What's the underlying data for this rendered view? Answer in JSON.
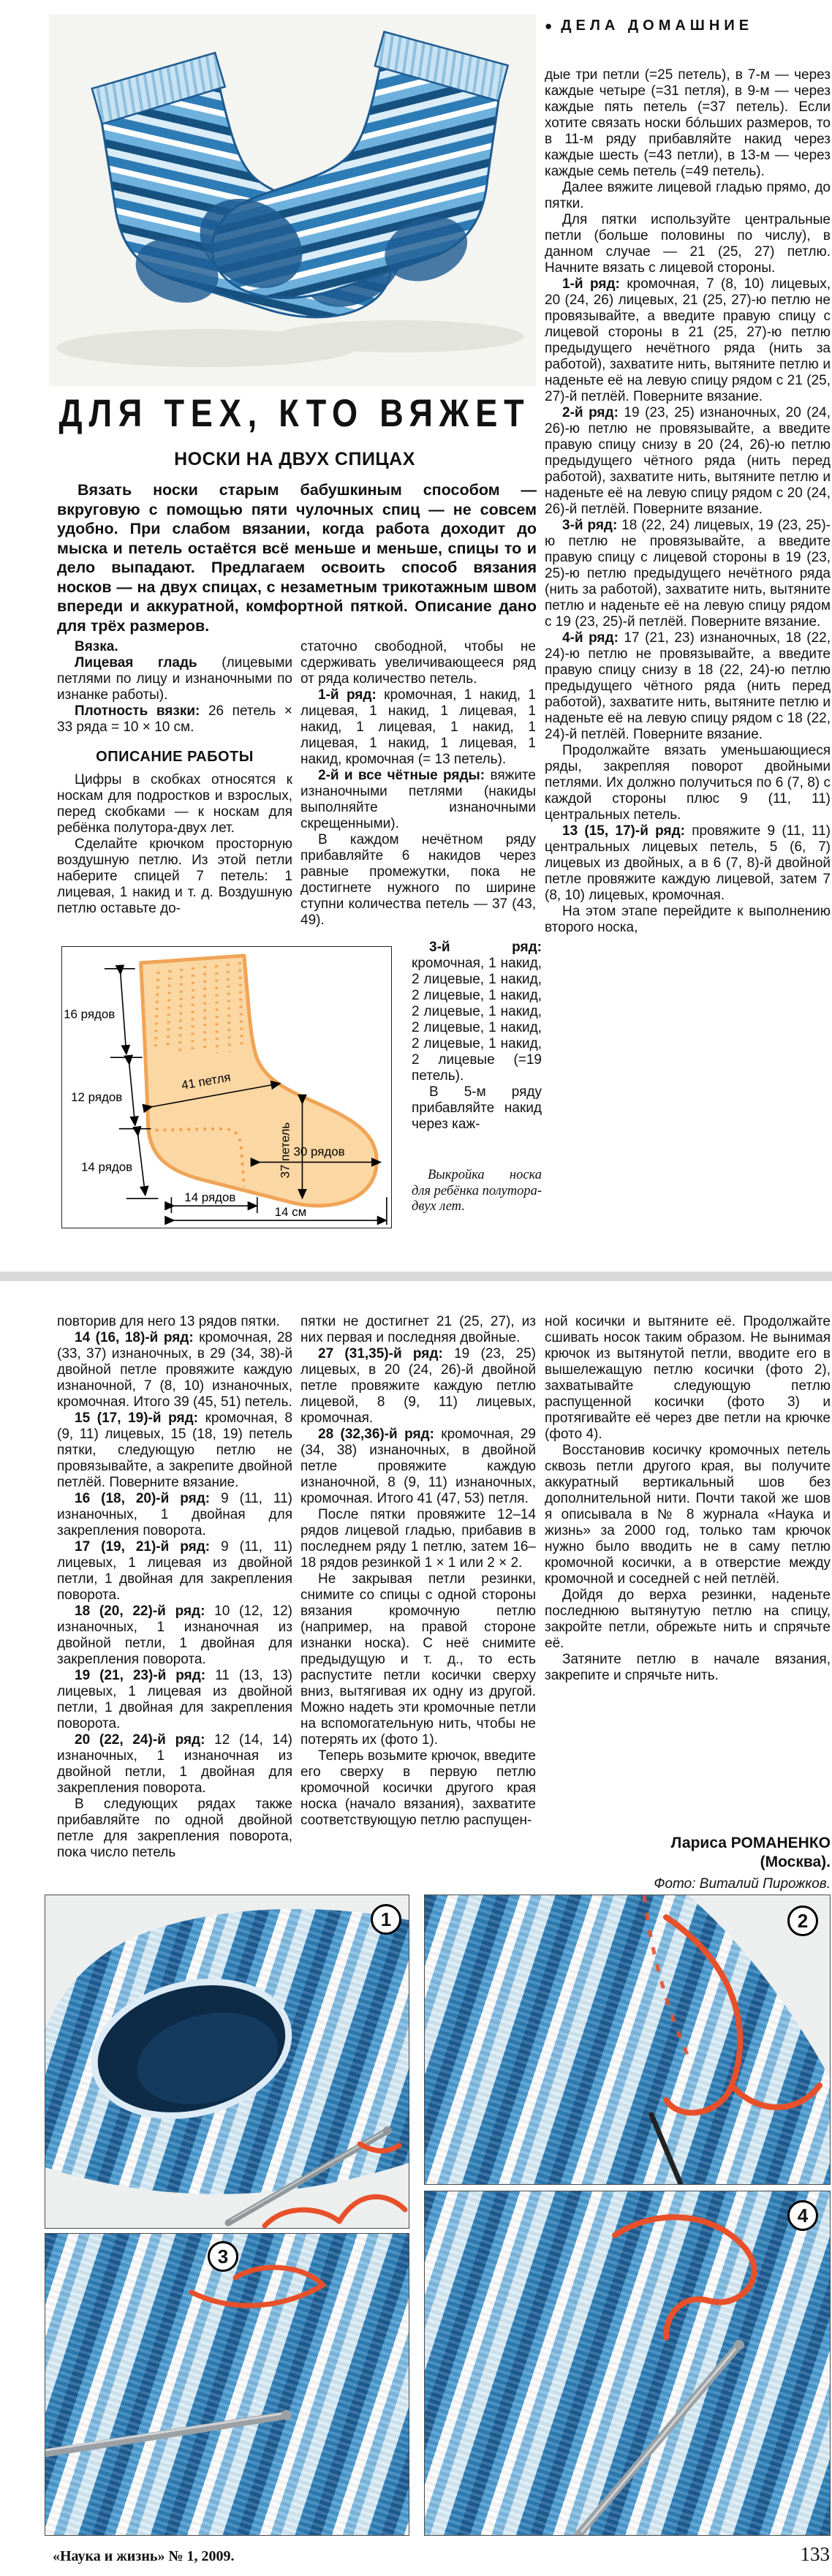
{
  "page": {
    "header": "ДЕЛА ДОМАШНИЕ",
    "header_bullet": "●",
    "title": "ДЛЯ ТЕХ, КТО ВЯЖЕТ",
    "subtitle": "НОСКИ НА ДВУХ СПИЦАХ",
    "footer_left": "«Наука и жизнь» № 1, 2009.",
    "footer_page": "133"
  },
  "intro": "Вязать носки старым бабушкиным способом — вкруговую с помощью пяти чулочных спиц — не совсем удобно. При слабом вязании, когда работа доходит до мыска и петель остаётся всё меньше и меньше, спицы то и дело выпадают. Предлагаем освоить способ вязания носков — на двух спицах, с незаметным трикотажным швом впереди и аккуратной, комфортной пяткой. Описание дано для трёх размеров.",
  "columns": {
    "col1": [
      {
        "lead": "Вязка.",
        "text": ""
      },
      {
        "lead": "Лицевая гладь",
        "text": "(лицевыми петлями по лицу и изнаночными по изнанке работы)."
      },
      {
        "lead": "Плотность вязки:",
        "text": "26 петель × 33 ряда = 10 × 10 см."
      },
      {
        "heading": true,
        "text": "ОПИСАНИЕ РАБОТЫ"
      },
      {
        "text": "Цифры в скобках относятся к носкам для подростков и взрослых, перед скобками — к носкам для ребёнка полутора-двух лет."
      },
      {
        "text": "Сделайте крючком просторную воздушную петлю. Из этой петли наберите спицей 7 петель: 1 лицевая, 1 накид и т. д. Воздушную петлю оставьте до-"
      }
    ],
    "col2": [
      {
        "noindent": true,
        "text": "статочно свободной, чтобы не сдерживать увеличивающееся ряд от ряда количество петель."
      },
      {
        "lead": "1-й ряд:",
        "text": "кромочная, 1 накид, 1 лицевая, 1 накид, 1 лицевая, 1 накид, 1 лицевая, 1 накид, 1 лицевая, 1 накид, 1 лицевая, 1 накид, кромочная (= 13 петель)."
      },
      {
        "lead": "2-й и все чётные ряды:",
        "text": "вяжите изнаночными петлями (накиды выполняйте изнаночными скрещенными)."
      },
      {
        "text": "В каждом нечётном ряду прибавляйте 6 накидов через равные промежутки, пока не достигнете нужного по ширине ступни количества петель — 37 (43, 49)."
      }
    ],
    "col2_narrow": [
      {
        "lead": "3-й ряд:",
        "text": "кромочная, 1 накид, 2 лицевые, 1 накид, 2 лицевые, 1 накид, 2 лицевые, 1 накид, 2 лицевые, 1 накид, 2 лицевые, 1 накид, 2 лицевые (=19 петель)."
      },
      {
        "text": "В 5-м ряду прибавляйте накид через каж-"
      }
    ],
    "col3": [
      {
        "noindent": true,
        "text": "дые три петли (=25 петель), в 7-м — через каждые четыре (=31 петля), в 9-м — через каждые пять петель (=37 петель). Если хотите связать носки бóльших размеров, то в 11-м ряду прибавляйте накид через каждые шесть (=43 петли), в 13-м — через каждые семь петель (=49 петель)."
      },
      {
        "text": "Далее вяжите лицевой гладью прямо, до пятки."
      },
      {
        "text": "Для пятки используйте центральные петли (больше половины по числу), в данном случае — 21 (25, 27) петлю. Начните вязать с лицевой стороны."
      },
      {
        "lead": "1-й ряд:",
        "text": "кромочная, 7 (8, 10) лицевых, 20 (24, 26) лицевых, 21 (25, 27)-ю петлю не провязывайте, а введите правую спицу с лицевой стороны в 21 (25, 27)-ю петлю предыдущего нечётного ряда (нить за работой), захватите нить, вытяните петлю и наденьте её на левую спицу рядом с 21 (25, 27)-й петлёй. Поверните вязание."
      },
      {
        "lead": "2-й ряд:",
        "text": "19 (23, 25) изнаночных, 20 (24, 26)-ю петлю не провязывайте, а введите правую спицу снизу в 20 (24, 26)-ю петлю предыдущего чётного ряда (нить перед работой), захватите нить, вытяните петлю и наденьте её на левую спицу рядом с 20 (24, 26)-й петлёй. Поверните вязание."
      },
      {
        "lead": "3-й ряд:",
        "text": "18 (22, 24) лицевых, 19 (23, 25)-ю петлю не провязывайте, а введите правую спицу с лицевой стороны в 19 (23, 25)-ю петлю предыдущего нечётного ряда (нить за работой), захватите нить, вытяните петлю и наденьте её на левую спицу рядом с 19 (23, 25)-й петлёй. Поверните вязание."
      },
      {
        "lead": "4-й ряд:",
        "text": "17 (21, 23) изнаночных, 18 (22, 24)-ю петлю не провязывайте, а введите правую спицу снизу в 18 (22, 24)-ю петлю предыдущего чётного ряда (нить перед работой), захватите нить, вытяните петлю и наденьте её на левую спицу рядом с 18 (22, 24)-й петлёй. Поверните вязание."
      },
      {
        "text": "Продолжайте вязать уменьшающиеся ряды, закрепляя поворот двойными петлями. Их должно получиться по 6 (7, 8) с каждой стороны плюс 9 (11, 11) центральных петель."
      },
      {
        "lead": "13 (15, 17)-й ряд:",
        "text": "провяжите 9 (11, 11) центральных лицевых петель, 5 (6, 7) лицевых из двойных, а в 6 (7, 8)-й двойной петле провяжите каждую лицевой, затем 7 (8, 10) лицевых, кромочная."
      },
      {
        "text": "На этом этапе перейдите к выполнению второго носка,"
      }
    ],
    "colA": [
      {
        "noindent": true,
        "text": "повторив для него 13 рядов пятки."
      },
      {
        "lead": "14 (16, 18)-й ряд:",
        "text": "кромочная, 28 (33, 37) изнаночных, в 29 (34, 38)-й двойной петле провяжите каждую изнаночной, 7 (8, 10) изнаночных, кромочная. Итого 39 (45, 51) петель."
      },
      {
        "lead": "15 (17, 19)-й ряд:",
        "text": "кромочная, 8 (9, 11) лицевых, 15 (18, 19) петель пятки, следующую петлю не провязывайте, а закрепите двойной петлёй. Поверните вязание."
      },
      {
        "lead": "16 (18, 20)-й ряд:",
        "text": "9 (11, 11) изнаночных, 1 двойная для закрепления поворота."
      },
      {
        "lead": "17 (19, 21)-й ряд:",
        "text": "9 (11, 11) лицевых, 1 лицевая из двойной петли, 1 двойная для закрепления поворота."
      },
      {
        "lead": "18 (20, 22)-й ряд:",
        "text": "10 (12, 12) изнаночных, 1 изнаночная из двойной петли, 1 двойная для закрепления поворота."
      },
      {
        "lead": "19 (21, 23)-й ряд:",
        "text": "11 (13, 13) лицевых, 1 лицевая из двойной петли, 1 двойная для закрепления поворота."
      },
      {
        "lead": "20 (22, 24)-й ряд:",
        "text": "12 (14, 14) изнаночных, 1 изнаночная из двойной петли, 1 двойная для закрепления поворота."
      },
      {
        "text": "В следующих рядах также прибавляйте по одной двойной петле для закрепления поворота, пока число петель"
      }
    ],
    "colB": [
      {
        "noindent": true,
        "text": "пятки не достигнет 21 (25, 27), из них первая и последняя двойные."
      },
      {
        "lead": "27 (31,35)-й ряд:",
        "text": "19 (23, 25) лицевых, в 20 (24, 26)-й двойной петле провяжите каждую петлю лицевой, 8 (9, 11) лицевых, кромочная."
      },
      {
        "lead": "28 (32,36)-й ряд:",
        "text": "кромочная, 29 (34, 38) изнаночных, в двойной петле провяжите каждую изнаночной, 8 (9, 11) изнаночных, кромочная. Итого 41 (47, 53) петля."
      },
      {
        "text": "После пятки провяжите 12–14 рядов лицевой гладью, прибавив в последнем ряду 1 петлю, затем 16–18 рядов резинкой 1 × 1 или 2 × 2."
      },
      {
        "text": "Не закрывая петли резинки, снимите со спицы с одной стороны вязания кромочную петлю (например, на правой стороне изнанки носка). С неё снимите предыдущую и т. д., то есть распустите петли косички сверху вниз, вытягивая их одну из другой. Можно надеть эти кромочные петли на вспомогательную нить, чтобы не потерять их (фото 1)."
      },
      {
        "text": "Теперь возьмите крючок, введите его сверху в первую петлю кромочной косички другого края носка (начало вязания), захватите соответствующую петлю распущен-"
      }
    ],
    "colC": [
      {
        "noindent": true,
        "text": "ной косички и вытяните её. Продолжайте сшивать носок таким образом. Не вынимая крючок из вытянутой петли, вводите его в вышележащую петлю косички (фото 2), захватывайте следующую петлю распущенной косички (фото 3) и протягивайте её через две петли на крючке (фото 4)."
      },
      {
        "text": "Восстановив косичку кромочных петель сквозь петли другого края, вы получите аккуратный вертикальный шов без дополнительной нити. Почти такой же шов я описывала в № 8 журнала «Наука и жизнь» за 2000 год, только там крючок нужно было вводить не в саму петлю кромочной косички, а в отверстие между кромочной и соседней с ней петлёй."
      },
      {
        "text": "Дойдя до верха резинки, наденьте последнюю вытянутую петлю на спицу, закройте петли, обрежьте нить и спрячьте её."
      },
      {
        "text": "Затяните петлю в начале вязания, закрепите и спрячьте нить."
      }
    ]
  },
  "author": {
    "name": "Лариса РОМАНЕНКО",
    "city": "(Москва).",
    "credit": "Фото: Виталий Пирожков."
  },
  "diagram": {
    "caption": "Выкройка носка для ребёнка полутора-двух лет.",
    "labels": {
      "rows16": "16 рядов",
      "rows12": "12 рядов",
      "rows14_left": "14 рядов",
      "loops41": "41 петля",
      "loops37": "37 петель",
      "rows30": "30 рядов",
      "rows14_bottom": "14 рядов",
      "cm14": "14 см"
    },
    "colors": {
      "fill": "#fbd7a3",
      "outline": "#f0a455"
    }
  },
  "photos": [
    {
      "number": "1"
    },
    {
      "number": "2"
    },
    {
      "number": "3"
    },
    {
      "number": "4"
    }
  ],
  "colors": {
    "thread_orange": "#e8502a",
    "knit_dark_blue": "#1d5d94",
    "knit_mid_blue": "#4b9bd0",
    "knit_light_blue": "#d9ecf7",
    "divider_gray": "#d9d9d9"
  }
}
